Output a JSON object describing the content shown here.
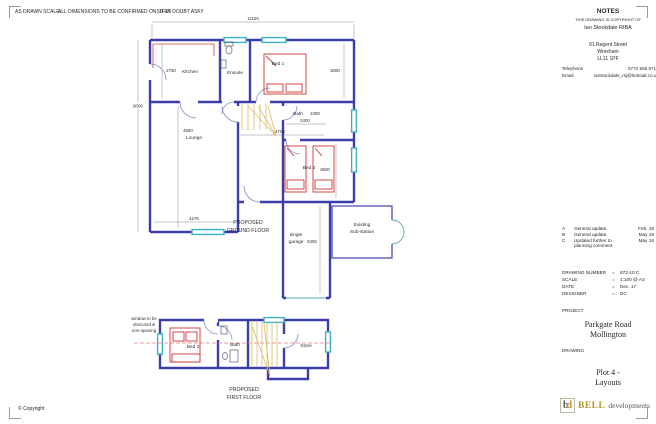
{
  "sheet": {
    "disclaimer_part1": "AS DRAWN SCALE:",
    "disclaimer_part2": "ALL DIMENSIONS TO BE CONFIRMED ONSITE!!",
    "disclaimer_part3": "IF IN DOUBT ASK!!",
    "copyright": "© Copyright"
  },
  "notes": {
    "title": "NOTES",
    "subtitle": "THIS DRAWING IS COPYRIGHT OF",
    "architect": "Ian Stockdale RIBA",
    "address1": "61 Regent Street",
    "address2": "Wrexham",
    "address3": "LL11 1PF",
    "telephone_label": "Telephone",
    "telephone_value": "0772 555 5715",
    "email_label": "Email",
    "email_value": "ianstockdale_rsj@hotmail.co.uk"
  },
  "revisions": [
    {
      "id": "A",
      "desc1": "General update.",
      "desc2": "",
      "date": "Feb. 18"
    },
    {
      "id": "B",
      "desc1": "General update.",
      "desc2": "",
      "date": "May 18"
    },
    {
      "id": "C",
      "desc1": "Updated further to",
      "desc2": "planning comment.",
      "date": "May 18"
    }
  ],
  "title_block": {
    "drawing_number_label": "DRAWING NUMBER",
    "drawing_number_value": "872-10  C",
    "scale_label": "SCALE",
    "scale_value": "1:100 @ A3",
    "date_label": "DATE",
    "date_value": "Dec. 17",
    "designer_label": "DESIGNER",
    "designer_value": "DC",
    "equals": "=",
    "project_label": "PROJECT",
    "project_line1": "Parkgate Road",
    "project_line2": "Mollington",
    "drawing_label": "DRAWING",
    "drawing_line1": "Plot 4 -",
    "drawing_line2": "Layouts"
  },
  "logo": {
    "monogram_b": "b",
    "monogram_d": "d",
    "name": "BELL",
    "suffix": "developments"
  },
  "ground_floor": {
    "title1": "PROPOSED",
    "title2": "GROUND FLOOR",
    "room_kitchen": "Kitchen",
    "room_ensuite": "Ensuite",
    "room_bed1": "Bed 1",
    "room_lounge": "Lounge",
    "room_bath": "Bath",
    "room_bed2": "Bed 2",
    "room_garage1": "single",
    "room_garage2": "garage",
    "substation1": "Existing",
    "substation2": "Sub-station",
    "dim_overall_width": "11125",
    "dim_overall_height": "9000",
    "dim_kitchen": "2750",
    "dim_lounge_v": "4550",
    "dim_lounge_h": "4275",
    "dim_bed1": "3600",
    "dim_bath_a": "2400",
    "dim_bath_b": "2400",
    "dim_hall": "4700",
    "dim_bed2": "3600",
    "dim_garage": "5455"
  },
  "first_floor": {
    "title1": "PROPOSED",
    "title2": "FIRST FLOOR",
    "note1": "window to be",
    "note2": "obscured &",
    "note3": "non-opening",
    "room_bed3": "Bed 3",
    "room_bath": "Bath",
    "room_store": "Store"
  },
  "colors": {
    "wall_blue": "#3d3da8",
    "window_cyan": "#3fb0c4",
    "furniture_red": "#cc3333",
    "stairs_tan": "#d8bc6a",
    "centerline_pink": "#e87878",
    "logo_gold": "#b5952f"
  }
}
